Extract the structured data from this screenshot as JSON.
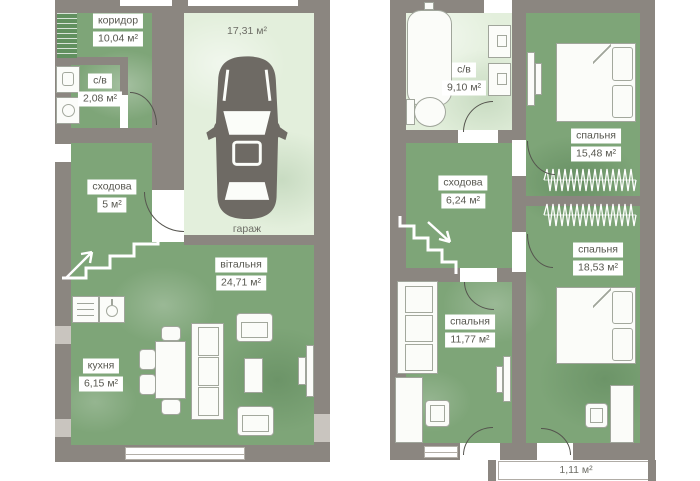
{
  "floor1": {
    "corridor": {
      "name": "коридор",
      "area": "10,04 м²"
    },
    "bathroom": {
      "name": "с/в",
      "area": "2,08 м²"
    },
    "stairwell": {
      "name": "сходова",
      "area": "5 м²"
    },
    "garage": {
      "name": "гараж",
      "area": "17,31 м²"
    },
    "living_room": {
      "name": "вітальня",
      "area": "24,71 м²"
    },
    "kitchen": {
      "name": "кухня",
      "area": "6,15 м²"
    }
  },
  "floor2": {
    "bathroom": {
      "name": "с/в",
      "area": "9,10 м²"
    },
    "bedroom_top_right": {
      "name": "спальня",
      "area": "15,48 м²"
    },
    "stairwell": {
      "name": "сходова",
      "area": "6,24 м²"
    },
    "bedroom_right": {
      "name": "спальня",
      "area": "18,53 м²"
    },
    "bedroom_left": {
      "name": "спальня",
      "area": "11,77 м²"
    },
    "balcony": {
      "area": "1,11 м²"
    }
  },
  "colors": {
    "wall": "#8b8680",
    "floor_green": "#7ea578",
    "floor_pale": "#e3efdc",
    "label_text": "#57574f"
  }
}
